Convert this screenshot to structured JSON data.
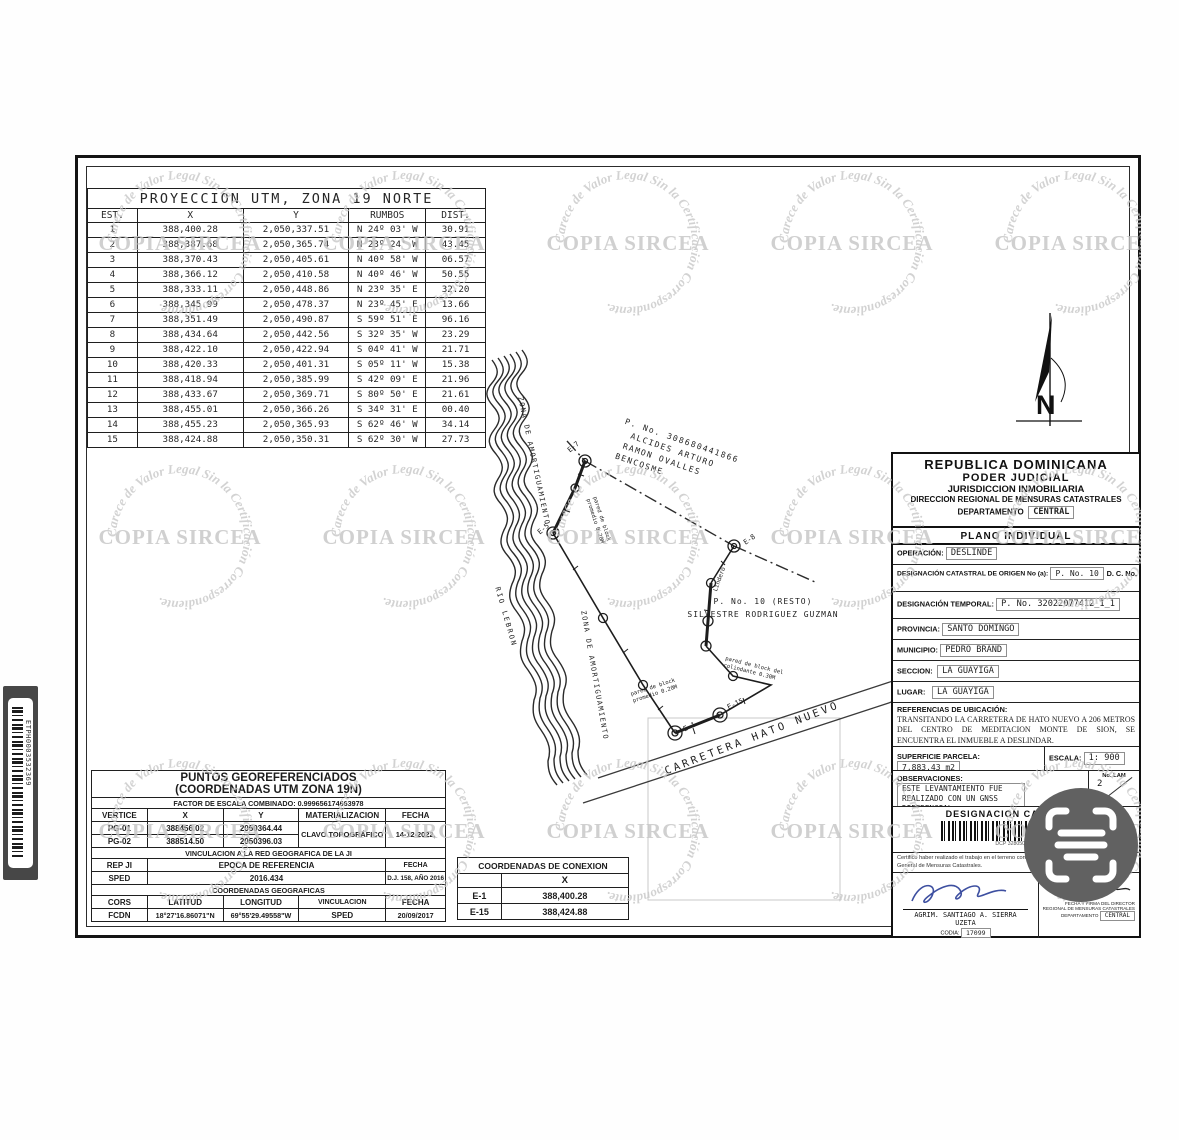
{
  "utm_table": {
    "title": "PROYECCION UTM, ZONA 19 NORTE",
    "headers": [
      "EST.",
      "X",
      "Y",
      "RUMBOS",
      "DIST."
    ],
    "rows": [
      [
        "1",
        "388,400.28",
        "2,050,337.51",
        "N 24º 03' W",
        "30.91"
      ],
      [
        "2",
        "388,387.68",
        "2,050,365.74",
        "N 23º 24' W",
        "43.45"
      ],
      [
        "3",
        "388,370.43",
        "2,050,405.61",
        "N 40º 58' W",
        "06.57"
      ],
      [
        "4",
        "388,366.12",
        "2,050,410.58",
        "N 40º 46' W",
        "50.55"
      ],
      [
        "5",
        "388,333.11",
        "2,050,448.86",
        "N 23º 35' E",
        "32.20"
      ],
      [
        "6",
        "388,345.99",
        "2,050,478.37",
        "N 23º 45' E",
        "13.66"
      ],
      [
        "7",
        "388,351.49",
        "2,050,490.87",
        "S 59º 51' E",
        "96.16"
      ],
      [
        "8",
        "388,434.64",
        "2,050,442.56",
        "S 32º 35' W",
        "23.29"
      ],
      [
        "9",
        "388,422.10",
        "2,050,422.94",
        "S 04º 41' W",
        "21.71"
      ],
      [
        "10",
        "388,420.33",
        "2,050,401.31",
        "S 05º 11' W",
        "15.38"
      ],
      [
        "11",
        "388,418.94",
        "2,050,385.99",
        "S 42º 09' E",
        "21.96"
      ],
      [
        "12",
        "388,433.67",
        "2,050,369.71",
        "S 80º 50' E",
        "21.61"
      ],
      [
        "13",
        "388,455.01",
        "2,050,366.26",
        "S 34º 31' E",
        "00.40"
      ],
      [
        "14",
        "388,455.23",
        "2,050,365.93",
        "S 62º 46' W",
        "34.14"
      ],
      [
        "15",
        "388,424.88",
        "2,050,350.31",
        "S 62º 30' W",
        "27.73"
      ]
    ]
  },
  "georef_table": {
    "title1": "PUNTOS GEOREFERENCIADOS",
    "title2": "(COORDENADAS UTM ZONA 19N)",
    "factor": "FACTOR DE ESCALA COMBINADO: 0.999656174663978",
    "headers": [
      "VERTICE",
      "X",
      "Y",
      "MATERIALIZACION",
      "FECHA"
    ],
    "pg01": [
      "PG-01",
      "388456.02",
      "2050364.44"
    ],
    "pg02": [
      "PG-02",
      "388514.50",
      "2050396.03"
    ],
    "materializacion": "CLAVO TOPOGRÁFICO",
    "fecha_pg": "14-12-2022,",
    "vinc_title": "VINCULACION A LA RED GEOGRAFICA DE LA JI",
    "rep_headers": [
      "REP JI",
      "EPOCA DE REFERENCIA",
      "FECHA"
    ],
    "rep_row": [
      "SPED",
      "2016.434",
      "D.J. 158, AÑO 2016"
    ],
    "geo_title": "COORDENADAS GEOGRAFICAS",
    "cors_headers": [
      "CORS",
      "LATITUD",
      "LONGITUD",
      "VINCULACION",
      "FECHA"
    ],
    "cors_row": [
      "FCDN",
      "18°27'16.86071\"N",
      "69°55'29.49558\"W",
      "SPED",
      "20/09/2017"
    ]
  },
  "conexion_table": {
    "title": "COORDENADAS DE CONEXION",
    "header_x": "X",
    "rows": [
      [
        "E-1",
        "388,400.28"
      ],
      [
        "E-15",
        "388,424.88"
      ]
    ]
  },
  "right_panel": {
    "header": {
      "line1": "REPUBLICA  DOMINICANA",
      "line2": "PODER  JUDICIAL",
      "line3": "JURISDICCION INMOBILIARIA",
      "line4": "DIRECCION REGIONAL DE MENSURAS CATASTRALES",
      "line5": "DEPARTAMENTO",
      "departamento": "CENTRAL"
    },
    "plano": "PLANO INDIVIDUAL",
    "operacion_label": "OPERACIÓN:",
    "operacion": "DESLINDE",
    "origen_label": "DESIGNACIÓN CATASTRAL  DE ORIGEN No (a):",
    "origen": "P. No. 10",
    "dc_label": "D. C. No.",
    "temporal_label": "DESIGNACIÓN TEMPORAL:",
    "temporal": "P. No. 32022077412_1_1",
    "provincia_label": "PROVINCIA:",
    "provincia": "SANTO DOMINGO",
    "municipio_label": "MUNICIPIO:",
    "municipio": "PEDRO BRAND",
    "seccion_label": "SECCION:",
    "seccion": "LA GUAYIGA",
    "lugar_label": "LUGAR:",
    "lugar": "LA GUAYIGA",
    "referencias_label": "REFERENCIAS DE UBICACIÓN:",
    "referencias": "TRANSITANDO LA CARRETERA DE HATO NUEVO A 206 METROS DEL CENTRO DE MEDITACION MONTE DE SION, SE ENCUENTRA EL INMUEBLE A DESLINDAR.",
    "superficie_label": "SUPERFICIE PARCELA:",
    "superficie": "7,883.43 m2",
    "escala_label": "ESCALA:",
    "escala": "1: 900",
    "observaciones_label": "OBSERVACIONES:",
    "observaciones_1": "ESTE LEVANTAMIENTO FUE",
    "observaciones_2": "REALIZADO  CON UN  GNSS DIFERENCIAL",
    "lam_label": "No. LAM",
    "lam": "2",
    "desig_cat_label": "DESIGNACION CATASTRAL",
    "desig_cat_sub": "DCP 3280503608",
    "certifico": "Certifico haber realizado el trabajo en el terreno conforme a lo dispuesto en el Reglamento General de Mensuras Catastrales.",
    "surveyor": "AGRIM. SANTIAGO A. SIERRA UZETA",
    "codia_label": "CODIA:",
    "codia": "17099",
    "director_line1": "FECHA Y FIRMA DEL DIRECTOR",
    "director_line2": "REGIONAL DE MENSURAS CATASTRALES",
    "director_line3": "DEPARTAMENTO",
    "director_dep": "CENTRAL"
  },
  "drawing": {
    "owner": {
      "line1": "P. No. 308680441866",
      "line2": "ALCIDES ARTURO",
      "line3": "RAMON OVALLES",
      "line4": "BENCOSME"
    },
    "resto": {
      "line1": "P. No. 10 (RESTO)",
      "line2": "SILVESTRE RODRIGUEZ GUZMAN"
    },
    "road": "CARRETERA HATO NUEVO",
    "river": "RIO LEBRON",
    "buffer1": "ZONA DE AMORTIGUAMIENTO",
    "buffer2": "ZONA DE AMORTIGUAMIENTO",
    "lindero": "Lindero",
    "wall_note_a1": "pared de block",
    "wall_note_a2": "promedio 0.20M",
    "wall_note_b1": "pared de block",
    "wall_note_b2": "promedio 0.20M",
    "wall_note_c1": "pared de block del",
    "wall_note_c2": "colindante 0.30M",
    "vertices": {
      "e7": "E-7",
      "e8": "E-8",
      "e5": "E-5",
      "e1": "E-1",
      "e15": "E-15"
    },
    "north": "N"
  },
  "watermark": {
    "arc_text": "Carece de Valor Legal Sin la Certificación Correspondiente. ",
    "center_text": "COPIA SIRCEA"
  },
  "barcode_label": "ETPH0003532369"
}
